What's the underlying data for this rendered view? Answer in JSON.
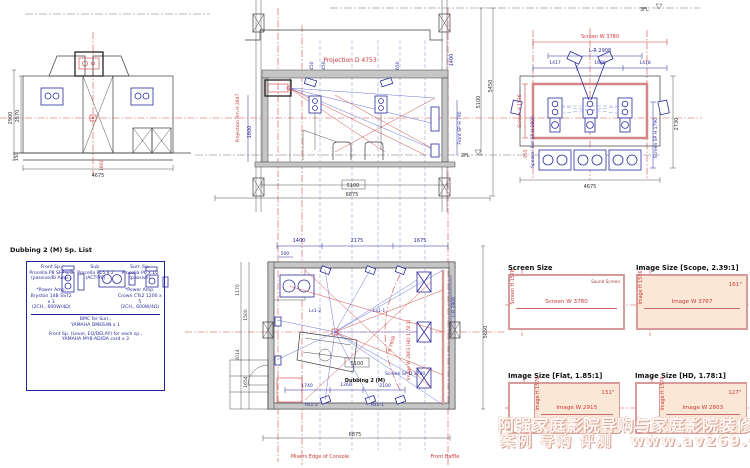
{
  "watermark": {
    "line1": "阿强家庭影院导购与家庭影院装修网",
    "line2": "案例 导购 评测",
    "url": "www.av269.com"
  },
  "colors": {
    "cad_blue": "#2b2b9d",
    "cad_red": "#cc3a3a",
    "panel_pink": "#d89b9b",
    "panel_peach": "#fbe7d6"
  },
  "left_elevation": {
    "h_total": "2900",
    "h_inner": "2570",
    "h_base": "150",
    "w": "4675",
    "door_h": "1800"
  },
  "section": {
    "level3": "3FL",
    "level2": "2FL",
    "projection": "Projection D 4753",
    "proj_h": "Projection Rm H 2847",
    "d450a": "450",
    "d450b": "450",
    "d650": "650",
    "dim_1800": "1800",
    "dim_1400": "1400",
    "front_sp": "Front SP H 790",
    "dim_v1": "5100",
    "dim_v2": "5450",
    "dim_box": "5100",
    "dim_bottom": "6875"
  },
  "front_elevation": {
    "screen_w": "Screen W 3780",
    "lr": "L-R 2908",
    "d1": "1417",
    "d2": "1680",
    "d3": "1418",
    "screen_h": "Screen H 1576",
    "d955": "955",
    "sp_set": "Speaker Set SP H 1800",
    "sp_h": "Screen SP H 1790",
    "right": "2730",
    "bottom": "4675"
  },
  "sp_list": {
    "title": "Dubbing 2 (M) Sp. List",
    "front_name": "Front Sp.",
    "front_model": "Procella P8 SFP x 3",
    "front_note": "(passive/Bi Amp.)",
    "front_amp1": "*Power Amp.",
    "front_amp2": "Bryston 14B SST2 x 3",
    "front_amp3": "(2CH., 600W/4Ω)",
    "sub_name": "Sub.",
    "sub_model": "Procella P15 x 2",
    "sub_note": "(ACTIVE)",
    "sur_name": "Surr. Sp.",
    "sur_model": "Procella P6 x 10",
    "sur_note": "(passive)",
    "sur_amp1": "*Power Amp.",
    "sur_amp2": "Crown CTs2 1200 x 5",
    "sur_amp3": "(2CH., 600W/4Ω)",
    "note1": "BMC for Surr.,",
    "note2": "YAMAHA DME64N x 1",
    "note3": "Front Sp. (Level, EQ/DELAY) for each sp.,",
    "note4": "YAMAHA MY8-AD/DA card x 3"
  },
  "plan": {
    "dim_t1": "1400",
    "dim_t2": "2175",
    "dim_t3": "1675",
    "dim_500": "500",
    "dim_l1": "1170",
    "dim_l2": "1500",
    "dim_l3": "2014",
    "dim_l4": "1654",
    "dim_r": "5650",
    "lr": "L-R 2908",
    "image_w": "Image W 2803 [HD 1.78:1]",
    "radius": "R 7958",
    "tag_ls2": "Ls1-2",
    "tag_ls1": "Ls1-1",
    "tag_rs2": "Rs1-2",
    "tag_rs1": "Rs1-1",
    "dim_1740": "1740",
    "dim_1260": "1260",
    "dim_2100": "2100",
    "room": "Dubbing 2 (M)",
    "screen_sp": "Screen SP D 3780",
    "dim_box": "5100",
    "dim_bottom": "6875",
    "note_console": "Mixers Edge of Console",
    "note_baffle": "Front Baffle"
  },
  "panels": {
    "screen": {
      "title": "Screen Size",
      "note": "Sound Screen",
      "h": "Screen H 1576",
      "w": "Screen W 3780"
    },
    "scope": {
      "title": "Image Size [Scope, 2.39:1]",
      "h": "Image H 1576",
      "w": "Image W 3767",
      "diag": "161\""
    },
    "flat": {
      "title": "Image Size [Flat, 1.85:1]",
      "h": "Image H 1576",
      "w": "Image W 2915",
      "diag": "131\""
    },
    "hd": {
      "title": "Image Size [HD, 1.78:1]",
      "h": "Image H 1576",
      "w": "Image W 2803",
      "diag": "127\""
    }
  }
}
